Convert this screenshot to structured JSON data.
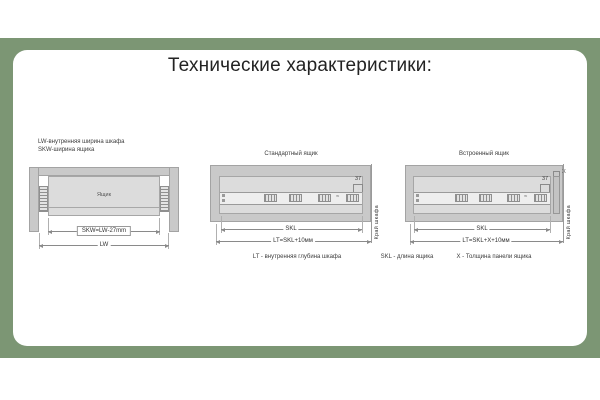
{
  "page": {
    "title": "Технические характеристики:"
  },
  "colors": {
    "accent_green": "#7c9674",
    "cabinet_gray": "#c9c9c9",
    "drawer_gray": "#dcdcdc",
    "dimension_line": "#8a8a8a"
  },
  "top_view": {
    "legend1": "LW-внутренняя ширина шкафа",
    "legend2": "SKW-ширина ящика",
    "drawer_label": "Ящик",
    "dim_skw": "SKW=LW-27mm",
    "dim_lw": "LW"
  },
  "standard_drawer": {
    "title": "Стандартный ящик",
    "dim_depth": "37",
    "break_symbol": "≈",
    "dim_skl": "SKL",
    "dim_lt": "LT=SKL+10мм",
    "cabinet_edge_label": "Край шкафа"
  },
  "inset_drawer": {
    "title": "Встроенный ящик",
    "dim_depth": "37",
    "dim_panel": "X",
    "break_symbol": "≈",
    "dim_skl": "SKL",
    "dim_lt": "LT=SKL+X+10мм",
    "cabinet_edge_label": "Край шкафа"
  },
  "definitions": {
    "lt": "LT - внутренняя глубина шкафа",
    "skl": "SKL - длина ящика",
    "x": "X - Толщина панели ящика"
  }
}
